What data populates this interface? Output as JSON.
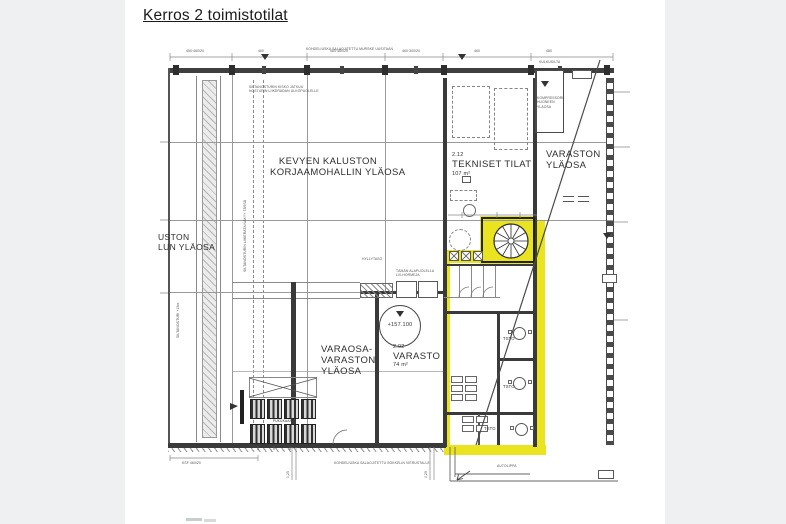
{
  "title": "Kerros 2 toimistotilat",
  "colors": {
    "highlight": "#e9e41f",
    "paper": "#ffffff",
    "margin": "#eff0f1",
    "line": "#3a3a3a"
  },
  "rooms": {
    "hall": {
      "line1": "KEVYEN KALUSTON",
      "line2": "KORJAAMOHALLIN YLÄOSA"
    },
    "tekniset": {
      "number": "2.12",
      "name": "TEKNISET TILAT",
      "area": "107 m²"
    },
    "varasto_upper": {
      "line1": "VARASTON",
      "line2": "YLÄOSA"
    },
    "kompressori": {
      "line1": "KOMPRESSORI-",
      "line2": "HUONEEN",
      "line3": "YLÄOSA"
    },
    "left_partial": {
      "line1": "USTON",
      "line2": "LUN YLÄOSA"
    },
    "varaosa": {
      "line1": "VARAOSA-",
      "line2": "VARASTON",
      "line3": "YLÄOSA"
    },
    "varasto": {
      "number": "2.02",
      "name": "VARASTO",
      "area": "74 m²"
    },
    "offices": {
      "tsto1": "TSTO",
      "tsto2": "TSTO",
      "tsto3": "TSTO"
    }
  },
  "markers": {
    "level": "+157.100",
    "canopy": "AUTOLIPPA"
  },
  "annotations": {
    "crane_rail_note1": "SILTANOSTURIN KISKO JATKUU",
    "crane_rail_note2": "NOSTURIN LIIKERADAN ULKOPUOLELLE",
    "top_note": "KOHDELIUSKA SALAOJITETTU MURSKE UUSITAAN",
    "right_top_note": "KULKUSILTA",
    "crane_path_vertical": "SILTANOSTURIN LIIKERATA NÄKYY TÄSSÄ",
    "crane_vertical": "SILTANOSTURI +15m",
    "walkway_note1": "TÄMÄN ALAPUOLELLA",
    "walkway_note2": "LVI-HORMEJA",
    "shelf_note": "HYLLYTASO",
    "lockers_note": "PUKUKAAPIT",
    "bottom_note": "KOHDELIUSKA SALAOJITETTU SOKKELIN VIERUSTALLE",
    "dim_left_bottom": "KSF 460/20",
    "tilt1": "0,25",
    "tilt2": "0,25"
  },
  "dims": {
    "top": [
      "450·460/20",
      "460",
      "480·460/20",
      "460·300/20",
      "460",
      "480"
    ]
  }
}
